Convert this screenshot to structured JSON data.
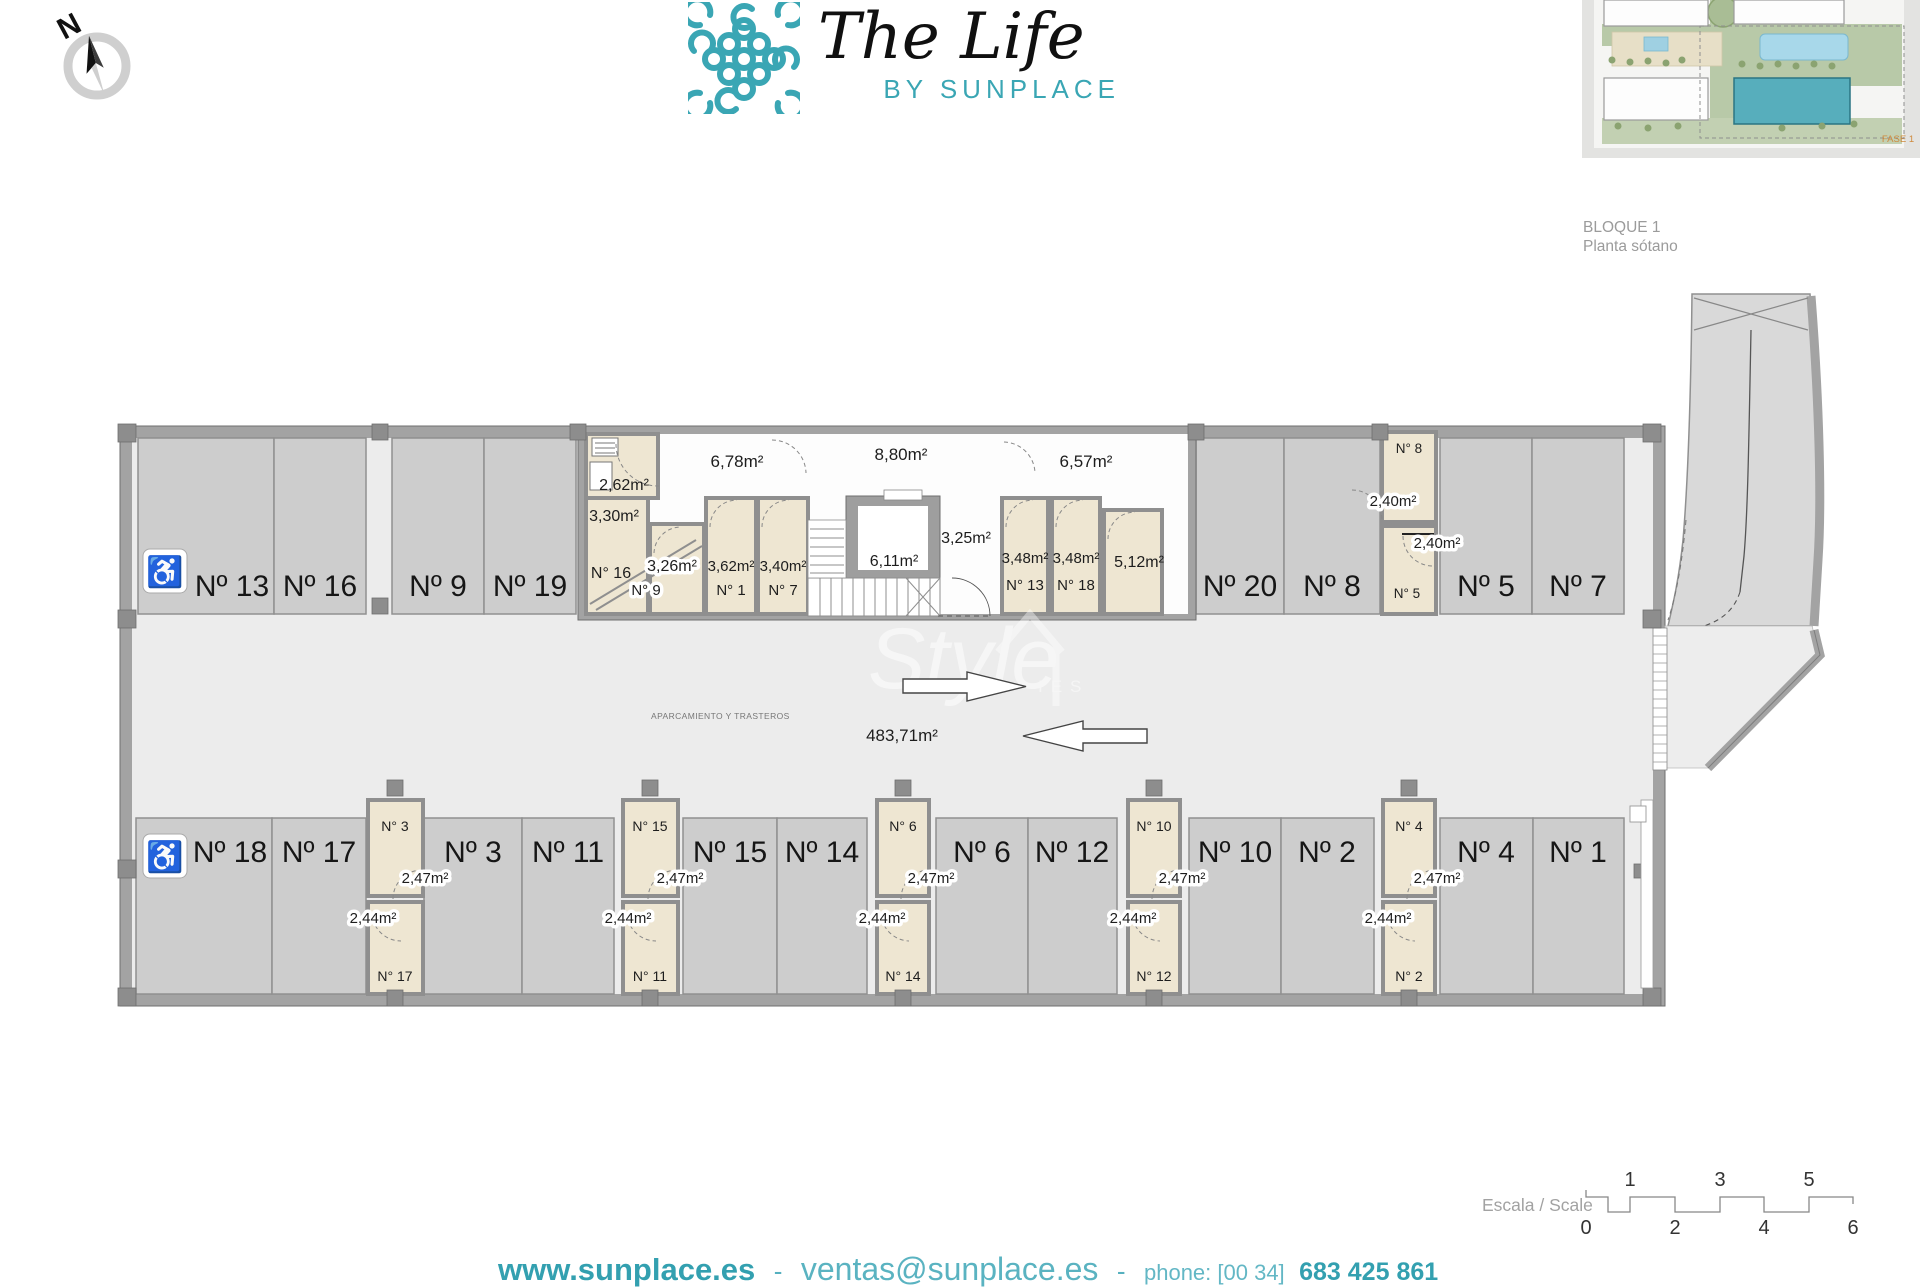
{
  "compass": {
    "label": "N"
  },
  "logo": {
    "title": "The Life",
    "subtitle": "BY SUNPLACE",
    "accent": "#3aa6b4"
  },
  "sheet": {
    "block": "BLOQUE 1",
    "floor": "Planta sótano",
    "site_phase": "FASE 1"
  },
  "watermark": {
    "text": "Style",
    "sub": "IES"
  },
  "icons": {
    "wheelchair": "♿"
  },
  "plan": {
    "use_label": "APARCAMIENTO Y TRASTEROS",
    "total_area": "483,71m²",
    "parking_top": [
      {
        "label": "Nº 13",
        "handicap": true
      },
      {
        "label": "Nº 16"
      },
      {
        "label": "Nº 9"
      },
      {
        "label": "Nº 19"
      },
      {
        "label": "Nº 20"
      },
      {
        "label": "Nº 8"
      },
      {
        "label": "Nº 5"
      },
      {
        "label": "Nº 7"
      }
    ],
    "parking_bottom": [
      {
        "label": "Nº 18",
        "handicap": true
      },
      {
        "label": "Nº 17"
      },
      {
        "label": "Nº 3"
      },
      {
        "label": "Nº 11"
      },
      {
        "label": "Nº 15"
      },
      {
        "label": "Nº 14"
      },
      {
        "label": "Nº 6"
      },
      {
        "label": "Nº 12"
      },
      {
        "label": "Nº 10"
      },
      {
        "label": "Nº 2"
      },
      {
        "label": "Nº 4"
      },
      {
        "label": "Nº 1"
      }
    ],
    "storerooms_top": {
      "r262": "2,62m²",
      "r330": "3,30m²",
      "n16": "N° 16",
      "r326": "3,26m²",
      "n9": "N° 9",
      "c678": "6,78m²",
      "r362": "3,62m²",
      "n1": "N° 1",
      "r340": "3,40m²",
      "n7": "N° 7",
      "c880": "8,80m²",
      "lift": "6,11m²",
      "lobby": "3,25m²",
      "r348a": "3,48m²",
      "n13": "N° 13",
      "r348b": "3,48m²",
      "n18": "N° 18",
      "r512": "5,12m²",
      "c657": "6,57m²",
      "n8": "N° 8",
      "r240a": "2,40m²",
      "r240b": "2,40m²",
      "n5": "N° 5"
    },
    "storeroom_columns": [
      {
        "top_num": "N° 3",
        "top_area": "2,47m²",
        "bottom_area": "2,44m²",
        "bottom_num": "N° 17"
      },
      {
        "top_num": "N° 15",
        "top_area": "2,47m²",
        "bottom_area": "2,44m²",
        "bottom_num": "N° 11"
      },
      {
        "top_num": "N° 6",
        "top_area": "2,47m²",
        "bottom_area": "2,44m²",
        "bottom_num": "N° 14"
      },
      {
        "top_num": "N° 10",
        "top_area": "2,47m²",
        "bottom_area": "2,44m²",
        "bottom_num": "N° 12"
      },
      {
        "top_num": "N° 4",
        "top_area": "2,47m²",
        "bottom_area": "2,44m²",
        "bottom_num": "N° 2"
      }
    ]
  },
  "scale_bar": {
    "label": "Escala / Scale",
    "ticks_top": [
      "1",
      "3",
      "5"
    ],
    "ticks_bottom": [
      "0",
      "2",
      "4",
      "6"
    ]
  },
  "footer": {
    "website": "www.sunplace.es",
    "sep_a": "-",
    "email": "ventas@sunplace.es",
    "sep_b": "-",
    "phone_label": "phone: [00 34]",
    "phone": "683 425 861"
  },
  "colors": {
    "teal": "#3aa6b4",
    "floor": "#ececec",
    "parking_fill": "#cdcdcd",
    "storage_fill": "#eee6d2",
    "wall": "#a3a3a3",
    "site_highlight": "#57aebc"
  }
}
